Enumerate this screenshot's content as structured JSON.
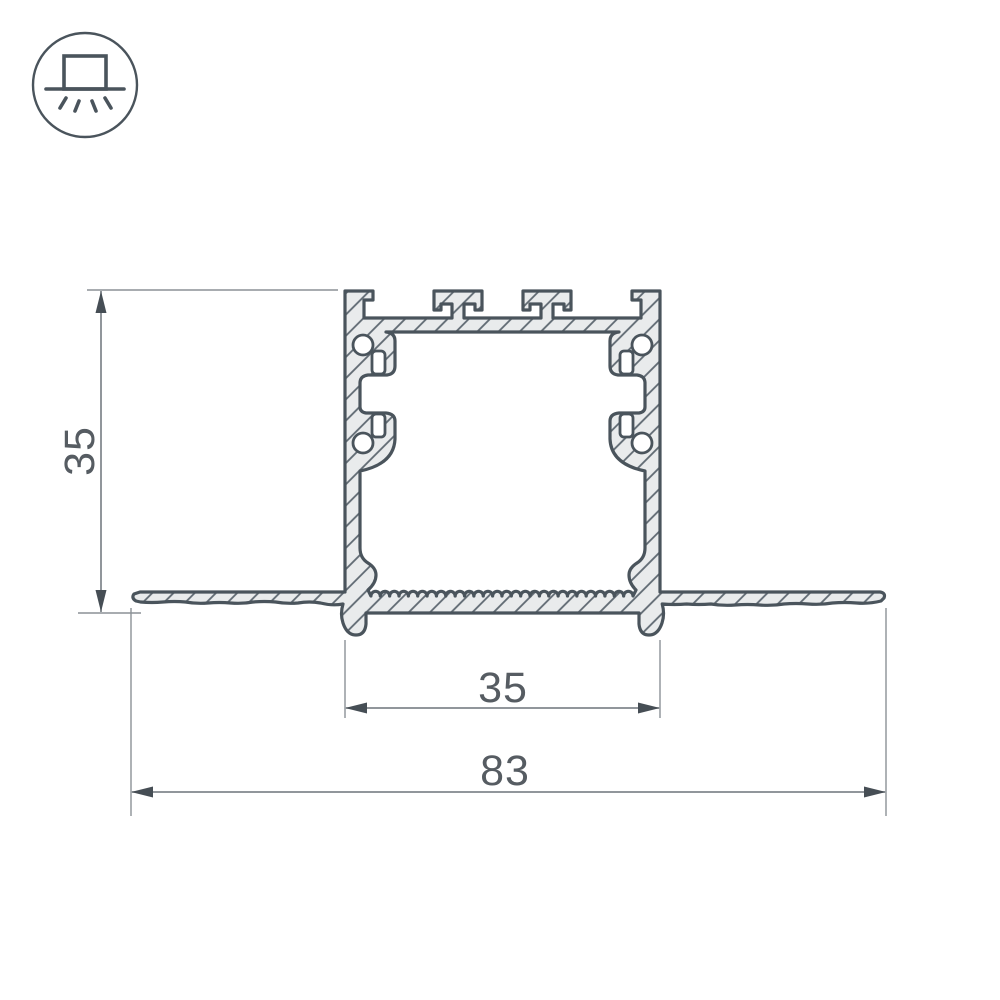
{
  "drawing": {
    "kind": "profile-cross-section-technical-drawing"
  },
  "icon": {
    "name": "recessed-light-icon"
  },
  "dimensions": {
    "height": {
      "value": "35"
    },
    "inner_width": {
      "value": "35"
    },
    "overall_width": {
      "value": "83"
    }
  },
  "colors": {
    "outline": "#4a545c",
    "fill": "#e9ebec",
    "hatch": "#5f6972",
    "dim": "#6d747a",
    "ext": "#8b9196",
    "arrow": "#464e55",
    "text": "#565c62",
    "background": "#ffffff"
  }
}
